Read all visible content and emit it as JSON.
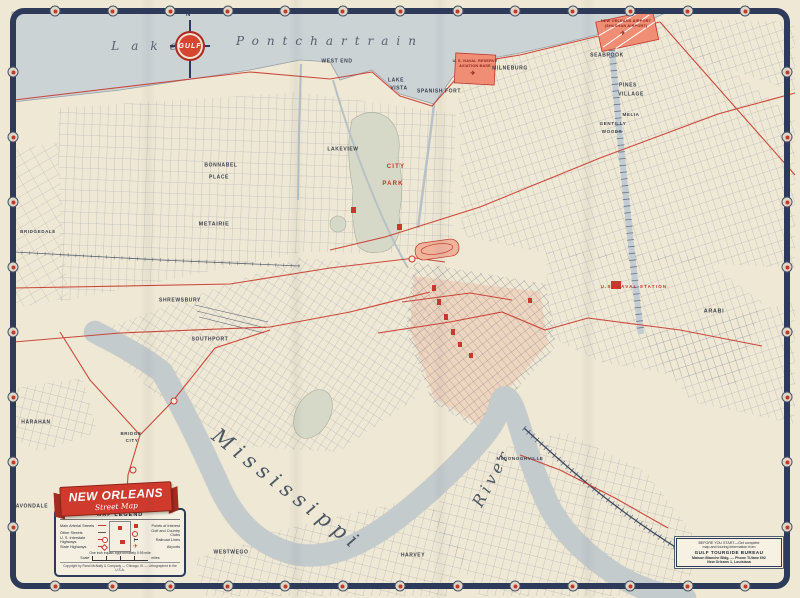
{
  "colors": {
    "accent_red": "#c8382c",
    "frame_navy": "#2d3a5a",
    "water": "#ccd3d5",
    "paper": "#efe8d4"
  },
  "logo": {
    "brand": "GULF",
    "compass_north": "N"
  },
  "legend": {
    "banner_title": "NEW ORLEANS",
    "banner_subtitle": "Street Map",
    "title": "MAP LEGEND",
    "rows": [
      {
        "left": "Main Arterial Streets",
        "right": "Points of Interest"
      },
      {
        "left": "Other Streets",
        "right": "Golf and Country Clubs"
      },
      {
        "left": "U. S. Interstate Highways",
        "right": "Railroad Lines"
      },
      {
        "left": "State Highways",
        "right": "Airports"
      }
    ],
    "scale_note": "One inch equals approximately 0.95 mile",
    "scale_label": "Scale",
    "scale_units": "miles",
    "copyright": "Copyright by Rand McNally & Company — Chicago, Ill. — Lithographed in the U.S.A."
  },
  "tourgide": {
    "line1": "BEFORE YOU START—Get complete",
    "line2": "map and touring information from",
    "title": "GULF TOURGIDE BUREAU",
    "line3": "Maison Blanche Bldg. — Phone TUlane 692",
    "line4": "New Orleans 1, Louisiana"
  },
  "map": {
    "labels": [
      {
        "t": "Lake",
        "x": 150,
        "y": 46,
        "k": "water",
        "fs": 12,
        "ls": 12
      },
      {
        "t": "Pontchartrain",
        "x": 330,
        "y": 41,
        "k": "water",
        "fs": 12,
        "ls": 8
      },
      {
        "t": "WEST END",
        "x": 337,
        "y": 62,
        "k": "town",
        "fs": 5
      },
      {
        "t": "LAKE",
        "x": 396,
        "y": 81,
        "k": "town",
        "fs": 5
      },
      {
        "t": "VISTA",
        "x": 399,
        "y": 89,
        "k": "town",
        "fs": 5
      },
      {
        "t": "SPANISH FORT",
        "x": 439,
        "y": 92,
        "k": "town",
        "fs": 5
      },
      {
        "t": "MILNEBURG",
        "x": 510,
        "y": 69,
        "k": "town",
        "fs": 5
      },
      {
        "t": "SEABROOK",
        "x": 607,
        "y": 56,
        "k": "town",
        "fs": 5
      },
      {
        "t": "PINES",
        "x": 628,
        "y": 86,
        "k": "town",
        "fs": 5
      },
      {
        "t": "VILLAGE",
        "x": 631,
        "y": 95,
        "k": "town",
        "fs": 5
      },
      {
        "t": "MELIA",
        "x": 631,
        "y": 115,
        "k": "town",
        "fs": 4.5
      },
      {
        "t": "GENTILLY",
        "x": 613,
        "y": 124,
        "k": "town",
        "fs": 4.5
      },
      {
        "t": "WOODS",
        "x": 612,
        "y": 132,
        "k": "town",
        "fs": 4.5
      },
      {
        "t": "LAKEVIEW",
        "x": 343,
        "y": 150,
        "k": "town",
        "fs": 5
      },
      {
        "t": "CITY",
        "x": 396,
        "y": 167,
        "k": "red",
        "fs": 6
      },
      {
        "t": "PARK",
        "x": 393,
        "y": 184,
        "k": "red",
        "fs": 6
      },
      {
        "t": "BONNABEL",
        "x": 221,
        "y": 166,
        "k": "town",
        "fs": 5
      },
      {
        "t": "PLACE",
        "x": 219,
        "y": 178,
        "k": "town",
        "fs": 5
      },
      {
        "t": "METAIRIE",
        "x": 214,
        "y": 225,
        "k": "town",
        "fs": 5.5
      },
      {
        "t": "BRIDGEDALE",
        "x": 38,
        "y": 232,
        "k": "town",
        "fs": 4.5
      },
      {
        "t": "SHREWSBURY",
        "x": 180,
        "y": 301,
        "k": "town",
        "fs": 5
      },
      {
        "t": "SOUTHPORT",
        "x": 210,
        "y": 340,
        "k": "town",
        "fs": 5
      },
      {
        "t": "HARAHAN",
        "x": 36,
        "y": 423,
        "k": "town",
        "fs": 5
      },
      {
        "t": "BRIDGE",
        "x": 131,
        "y": 434,
        "k": "town",
        "fs": 4.5
      },
      {
        "t": "CITY",
        "x": 132,
        "y": 441,
        "k": "town",
        "fs": 4.5
      },
      {
        "t": "AVONDALE",
        "x": 32,
        "y": 507,
        "k": "town",
        "fs": 5
      },
      {
        "t": "WESTWEGO",
        "x": 231,
        "y": 553,
        "k": "town",
        "fs": 5
      },
      {
        "t": "HARVEY",
        "x": 413,
        "y": 556,
        "k": "town",
        "fs": 5
      },
      {
        "t": "McDONOGHVILLE",
        "x": 520,
        "y": 459,
        "k": "town",
        "fs": 4.5
      },
      {
        "t": "ARABI",
        "x": 714,
        "y": 312,
        "k": "town",
        "fs": 5.5
      },
      {
        "t": "U.S. NAVAL STATION",
        "x": 634,
        "y": 287,
        "k": "red",
        "fs": 4.5
      },
      {
        "t": "Mississippi",
        "x": 287,
        "y": 490,
        "k": "script",
        "fs": 21,
        "ls": 6,
        "rot": 38
      },
      {
        "t": "River",
        "x": 492,
        "y": 478,
        "k": "script",
        "fs": 16,
        "ls": 4,
        "rot": -62
      },
      {
        "t": "NEW ORLEANS AIRPORT",
        "x": 626,
        "y": 22,
        "k": "redtiny",
        "fs": 3.8
      },
      {
        "t": "(SHUSHAN AIRPORT)",
        "x": 626,
        "y": 27,
        "k": "redtiny",
        "fs": 3.8
      },
      {
        "t": "✈",
        "x": 623,
        "y": 34,
        "k": "redtiny",
        "fs": 6,
        "name": "airplane-icon"
      },
      {
        "t": "U. S. NAVAL RESERVE",
        "x": 475,
        "y": 62,
        "k": "redtiny",
        "fs": 3.8
      },
      {
        "t": "AVIATION BASE",
        "x": 475,
        "y": 67,
        "k": "redtiny",
        "fs": 3.8
      },
      {
        "t": "✈",
        "x": 473,
        "y": 74,
        "k": "redtiny",
        "fs": 6,
        "name": "airplane-icon"
      }
    ]
  }
}
